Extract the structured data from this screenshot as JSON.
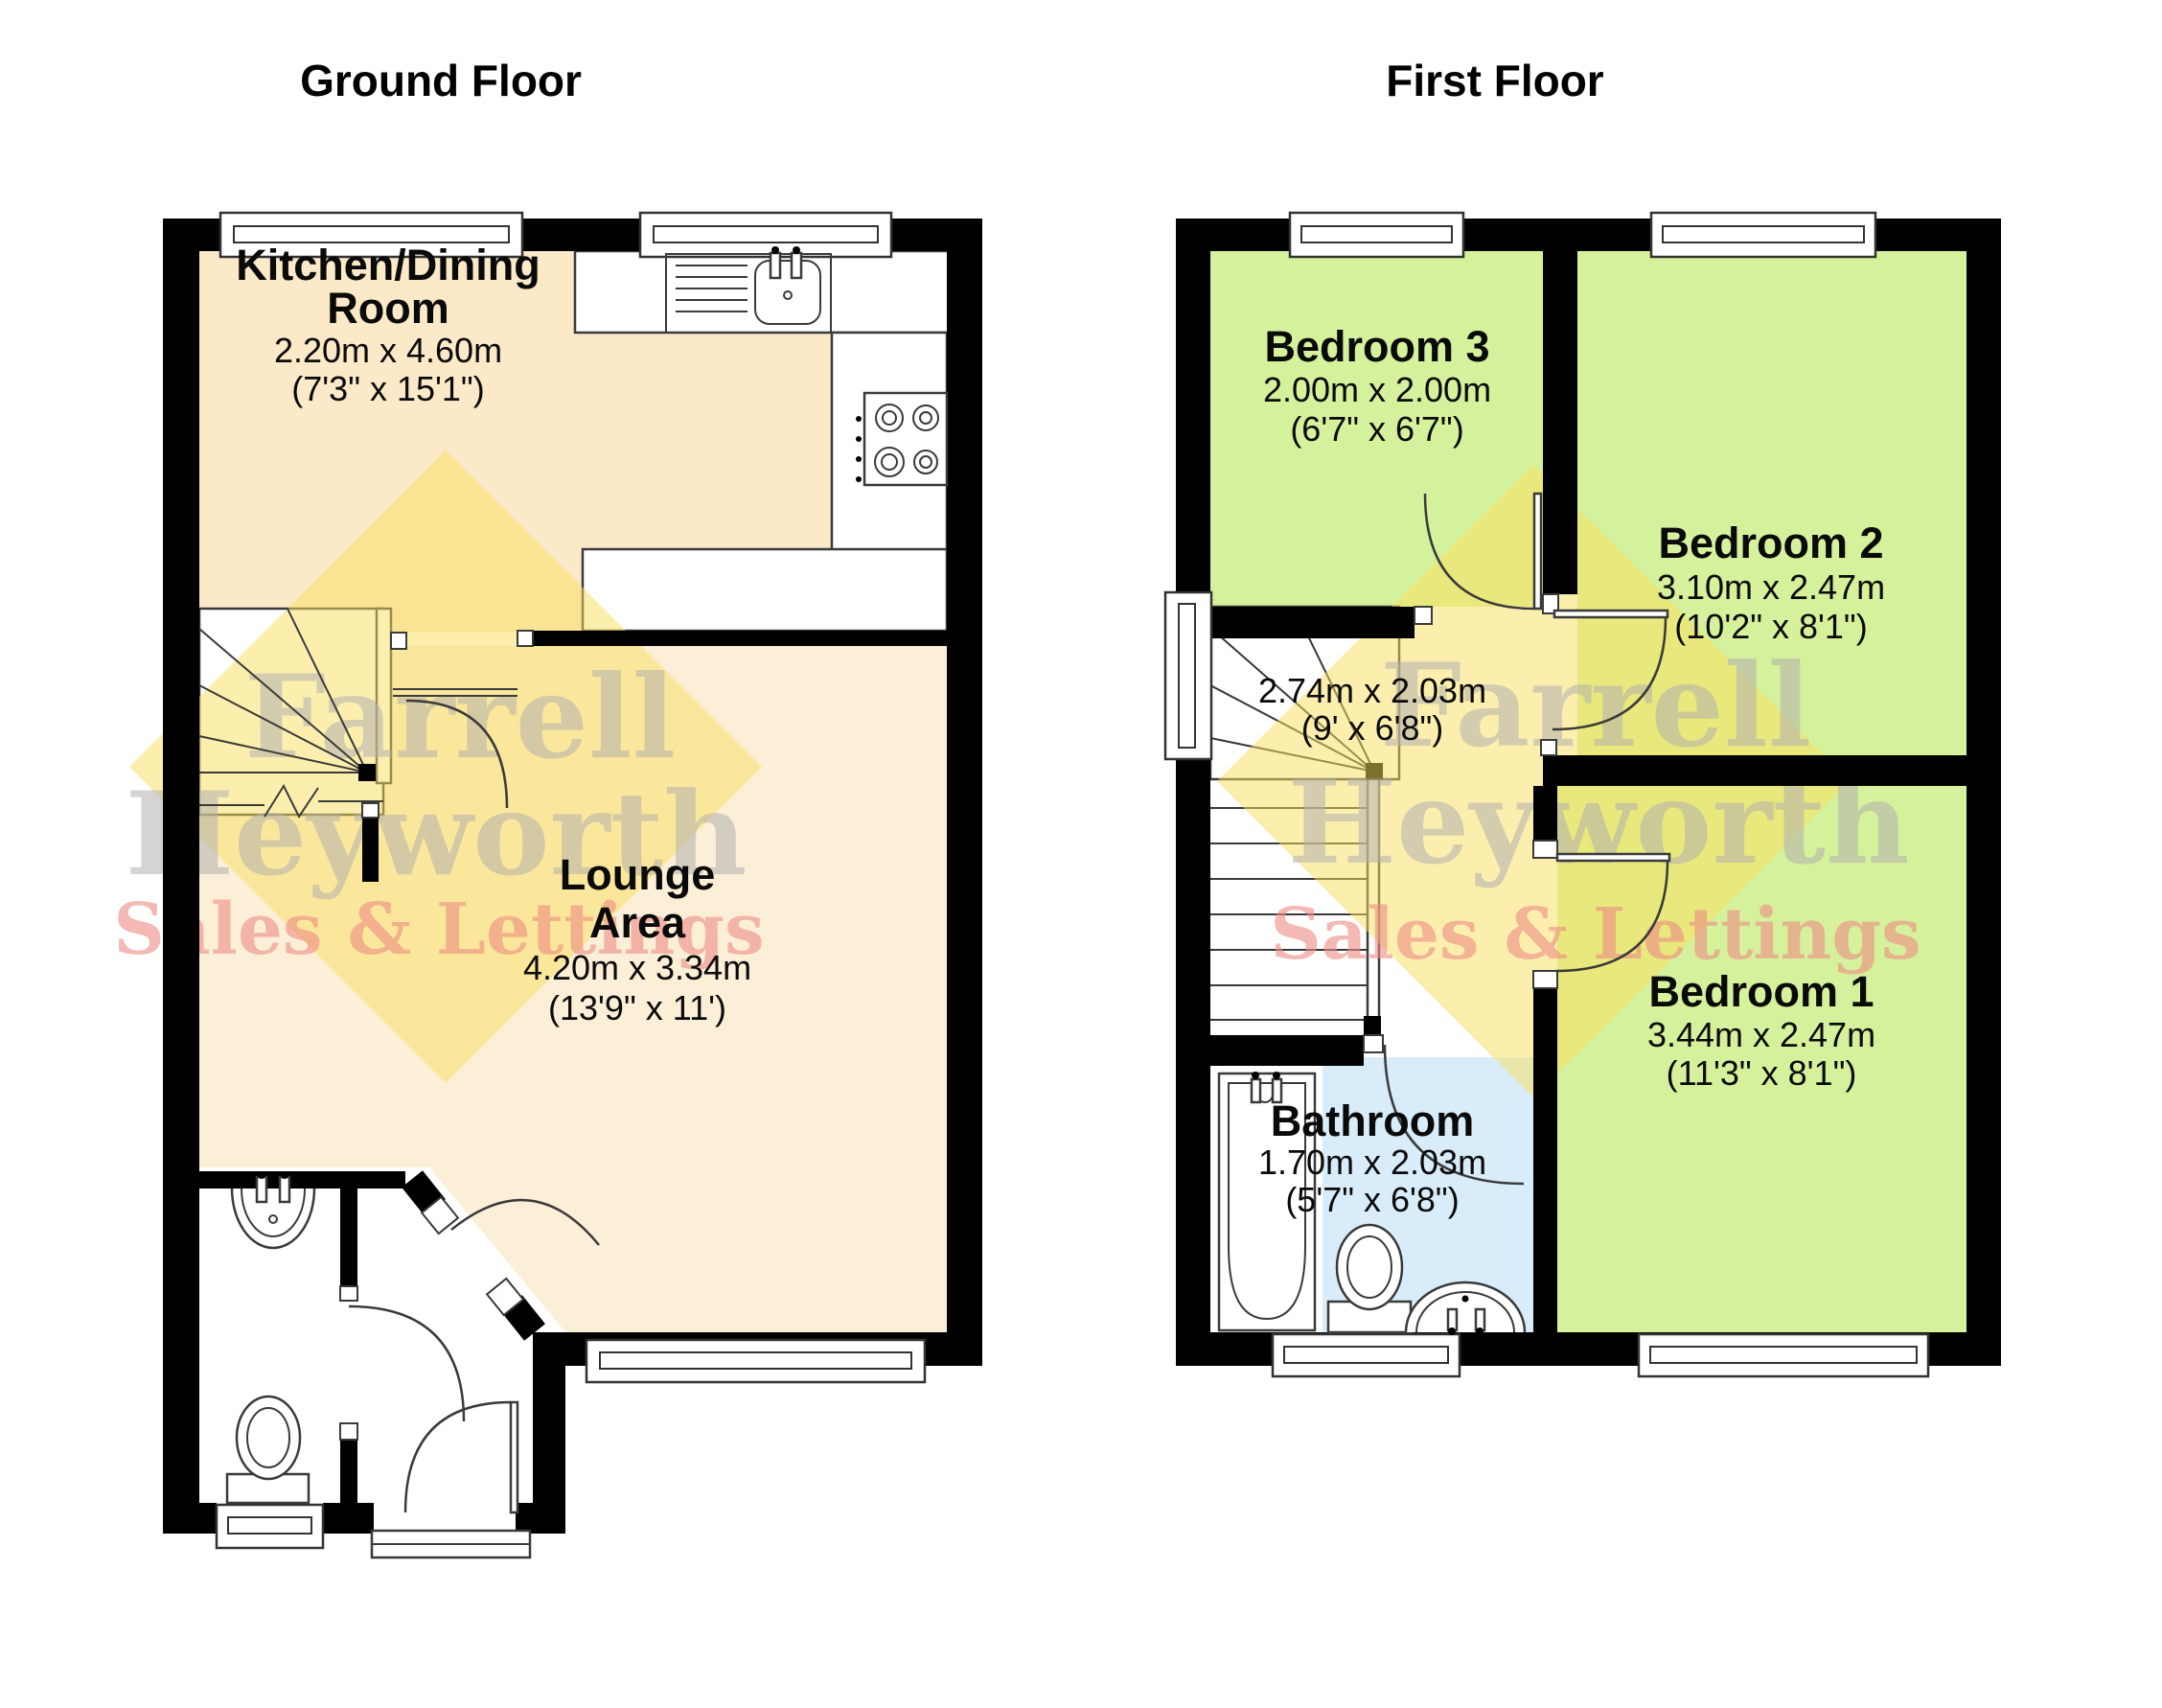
{
  "floors": {
    "ground": {
      "title": "Ground Floor",
      "rooms": {
        "kitchen": {
          "name_line1": "Kitchen/Dining",
          "name_line2": "Room",
          "dim_metric": "2.20m x 4.60m",
          "dim_imperial": "(7'3\" x 15'1\")"
        },
        "lounge": {
          "name_line1": "Lounge",
          "name_line2": "Area",
          "dim_metric": "4.20m x 3.34m",
          "dim_imperial": "(13'9\" x 11')"
        }
      }
    },
    "first": {
      "title": "First Floor",
      "rooms": {
        "bedroom3": {
          "name": "Bedroom 3",
          "dim_metric": "2.00m x 2.00m",
          "dim_imperial": "(6'7\" x 6'7\")"
        },
        "bedroom2": {
          "name": "Bedroom 2",
          "dim_metric": "3.10m x 2.47m",
          "dim_imperial": "(10'2\" x 8'1\")"
        },
        "landing": {
          "dim_metric": "2.74m x 2.03m",
          "dim_imperial": "(9' x 6'8\")"
        },
        "bathroom": {
          "name": "Bathroom",
          "dim_metric": "1.70m x 2.03m",
          "dim_imperial": "(5'7\" x 6'8\")"
        },
        "bedroom1": {
          "name": "Bedroom 1",
          "dim_metric": "3.44m x 2.47m",
          "dim_imperial": "(11'3\" x 8'1\")"
        }
      }
    }
  },
  "watermark": {
    "line1": "Farrell",
    "line2": "Heyworth",
    "line3": "Sales & Lettings"
  },
  "colors": {
    "bedroom_green": "#d6f19c",
    "bathroom_blue": "#d9ecfa",
    "kitchen_cream": "#fbe9c8",
    "lounge_cream": "#fcefd8",
    "watermark_yellow": "#fadf5e",
    "watermark_gray": "#b3b1ae",
    "watermark_red": "#ee8c85",
    "wall_black": "#000000"
  }
}
